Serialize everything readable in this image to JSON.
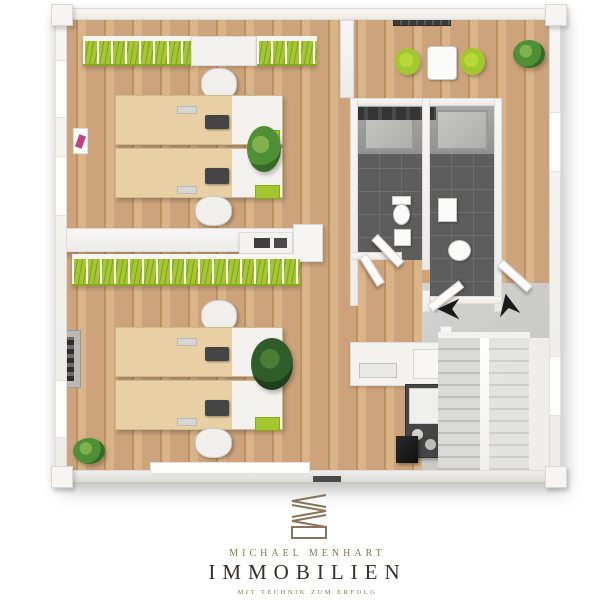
{
  "brand": {
    "name": "MICHAEL MENHART",
    "division": "IMMOBILIEN",
    "tagline": "MIT TECHNIK ZUM ERFOLG"
  },
  "colors": {
    "canvas_bg": "#ffffff",
    "wall": "#f2f1ee",
    "wall_shadow": "#cfcecb",
    "wood_floor": "#cda37b",
    "wood_floor_dark": "#bd9160",
    "wood_floor_light": "#dab489",
    "lime_green": "#a3c82d",
    "tile_dark": "#5d5d5d",
    "tile_line": "#6e6e6e",
    "concrete": "#cacac8",
    "stair_tread": "#dadad8",
    "stair_shadow": "#bebebc",
    "desk_wood": "#e8d0a4",
    "dark_cabinet": "#454545",
    "appliance_white": "#efefed",
    "plant_green": "#4f8f35",
    "plant_dark": "#2f5c28",
    "arrow_black": "#1a1a1a",
    "logo_gold": "#8a7458",
    "logo_dark": "#35302b",
    "accent_pink": "#c2417e"
  },
  "scene": {
    "type": "3d-floor-plan-top-view",
    "rooms": [
      "upper-office",
      "lower-office",
      "break-area",
      "bathroom-left",
      "bathroom-right",
      "kitchenette",
      "stair-hall"
    ],
    "furniture_counts": {
      "desks": 4,
      "office_chairs": 4,
      "green_shelving_rows": 2,
      "bistro_table": 1,
      "green_chairs": 2,
      "plants": 5,
      "toilets": 2,
      "sinks": 3,
      "staircases": 1,
      "direction_arrows": 2
    }
  }
}
